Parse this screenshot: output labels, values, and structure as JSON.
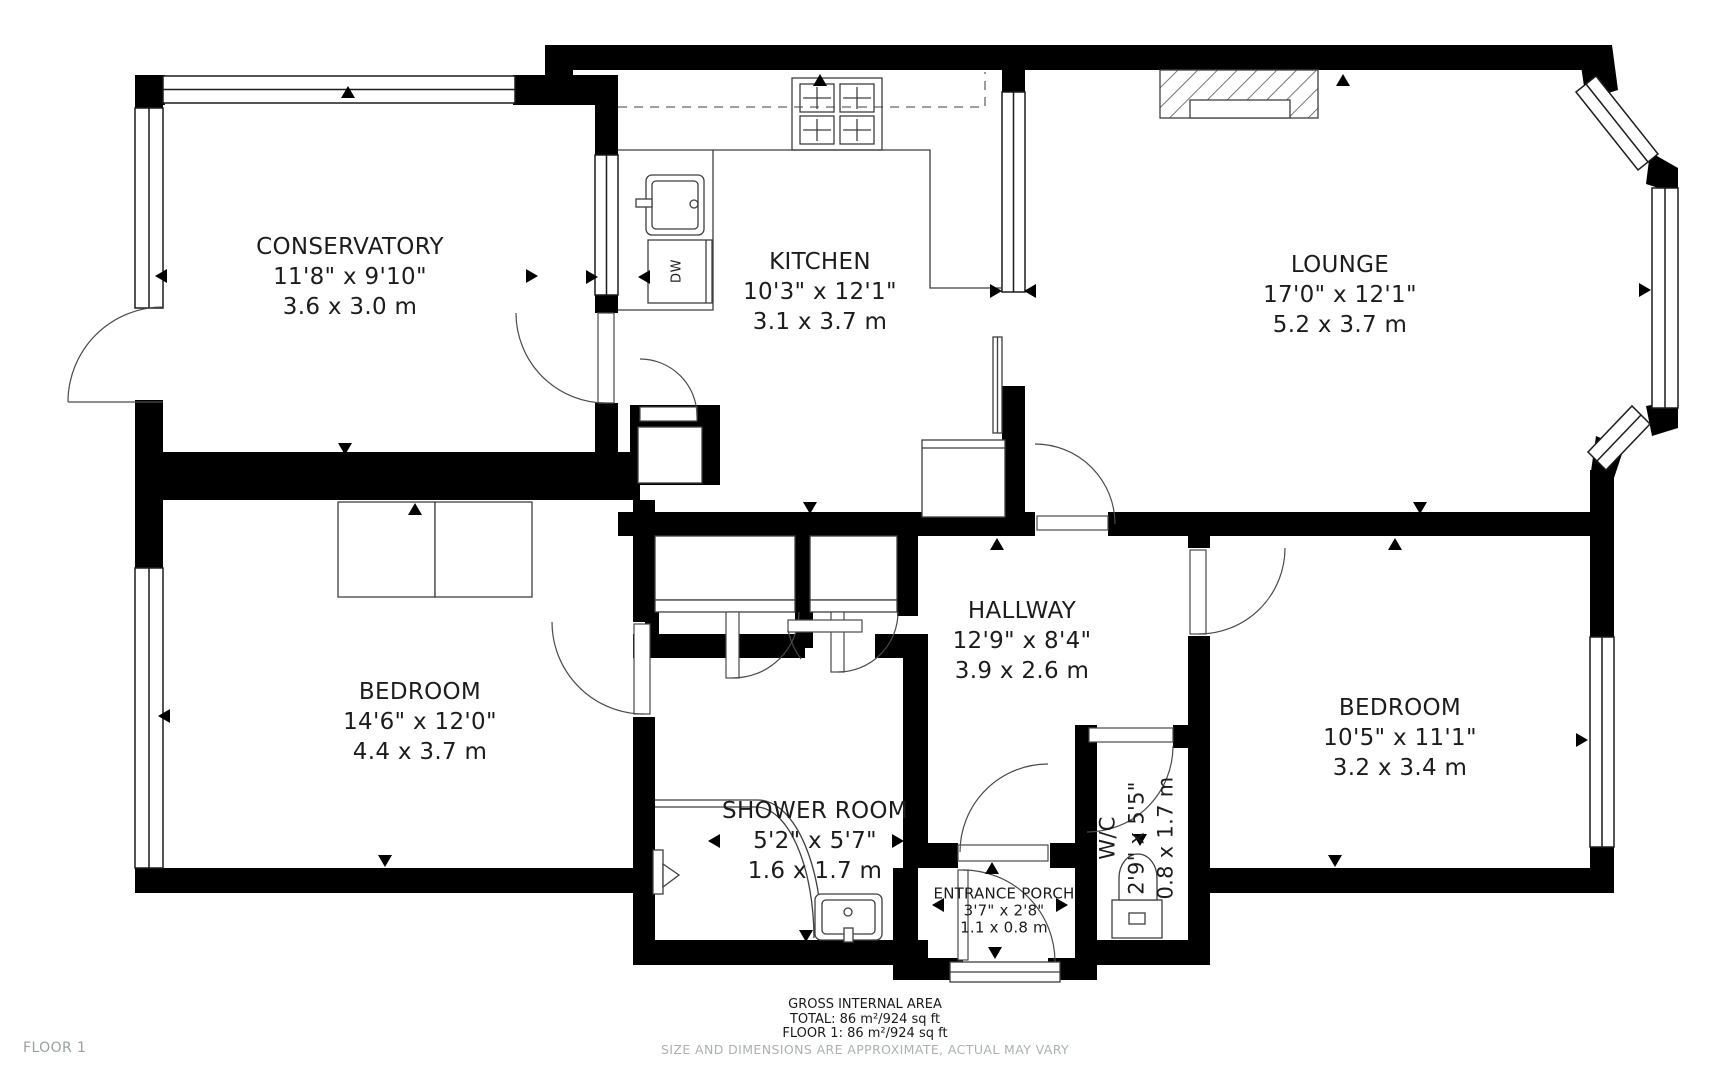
{
  "floorplan": {
    "floor_label": "FLOOR 1",
    "rooms": [
      {
        "name": "CONSERVATORY",
        "imperial": "11'8\" x 9'10\"",
        "metric": "3.6 x 3.0 m"
      },
      {
        "name": "KITCHEN",
        "imperial": "10'3\" x 12'1\"",
        "metric": "3.1 x 3.7 m"
      },
      {
        "name": "LOUNGE",
        "imperial": "17'0\" x 12'1\"",
        "metric": "5.2 x 3.7 m"
      },
      {
        "name": "BEDROOM",
        "imperial": "14'6\" x 12'0\"",
        "metric": "4.4 x 3.7 m"
      },
      {
        "name": "HALLWAY",
        "imperial": "12'9\" x 8'4\"",
        "metric": "3.9 x 2.6 m"
      },
      {
        "name": "BEDROOM",
        "imperial": "10'5\" x 11'1\"",
        "metric": "3.2 x 3.4 m"
      },
      {
        "name": "SHOWER ROOM",
        "imperial": "5'2\" x 5'7\"",
        "metric": "1.6 x 1.7 m"
      },
      {
        "name": "ENTRANCE PORCH",
        "imperial": "3'7\" x 2'8\"",
        "metric": "1.1 x 0.8 m"
      },
      {
        "name": "W/C",
        "imperial": "2'9\" x 5'5\"",
        "metric": "0.8 x 1.7 m"
      }
    ],
    "fixtures": {
      "dishwasher_label": "DW"
    },
    "footer": {
      "gross_area_title": "GROSS INTERNAL AREA",
      "total": "TOTAL: 86 m²/924 sq ft",
      "floor1": "FLOOR 1: 86 m²/924 sq ft",
      "disclaimer": "SIZE AND DIMENSIONS ARE APPROXIMATE, ACTUAL MAY VARY"
    },
    "colors": {
      "wall": "#000000",
      "thin_line": "#3f3f3f",
      "text": "#1c1c1c",
      "muted": "#a9b1b1"
    }
  }
}
